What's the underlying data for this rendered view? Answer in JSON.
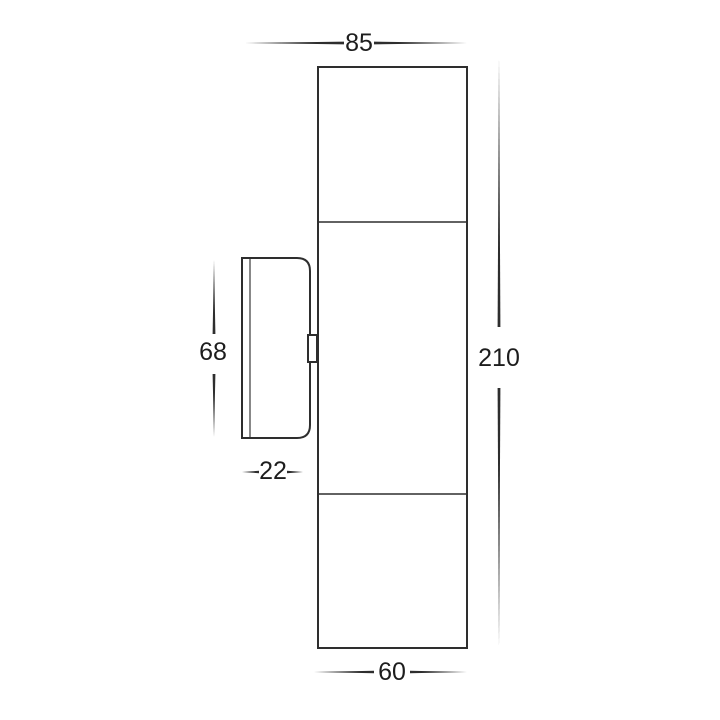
{
  "page": {
    "background_color": "#ffffff",
    "line_color": "#2e2e2e",
    "text_color": "#1d1d1d"
  },
  "drawing": {
    "kind": "technical-dimension-drawing",
    "dimensions": {
      "top_projection": "85",
      "overall_height": "210",
      "bracket_height": "68",
      "bracket_depth": "22",
      "body_width": "60"
    }
  }
}
